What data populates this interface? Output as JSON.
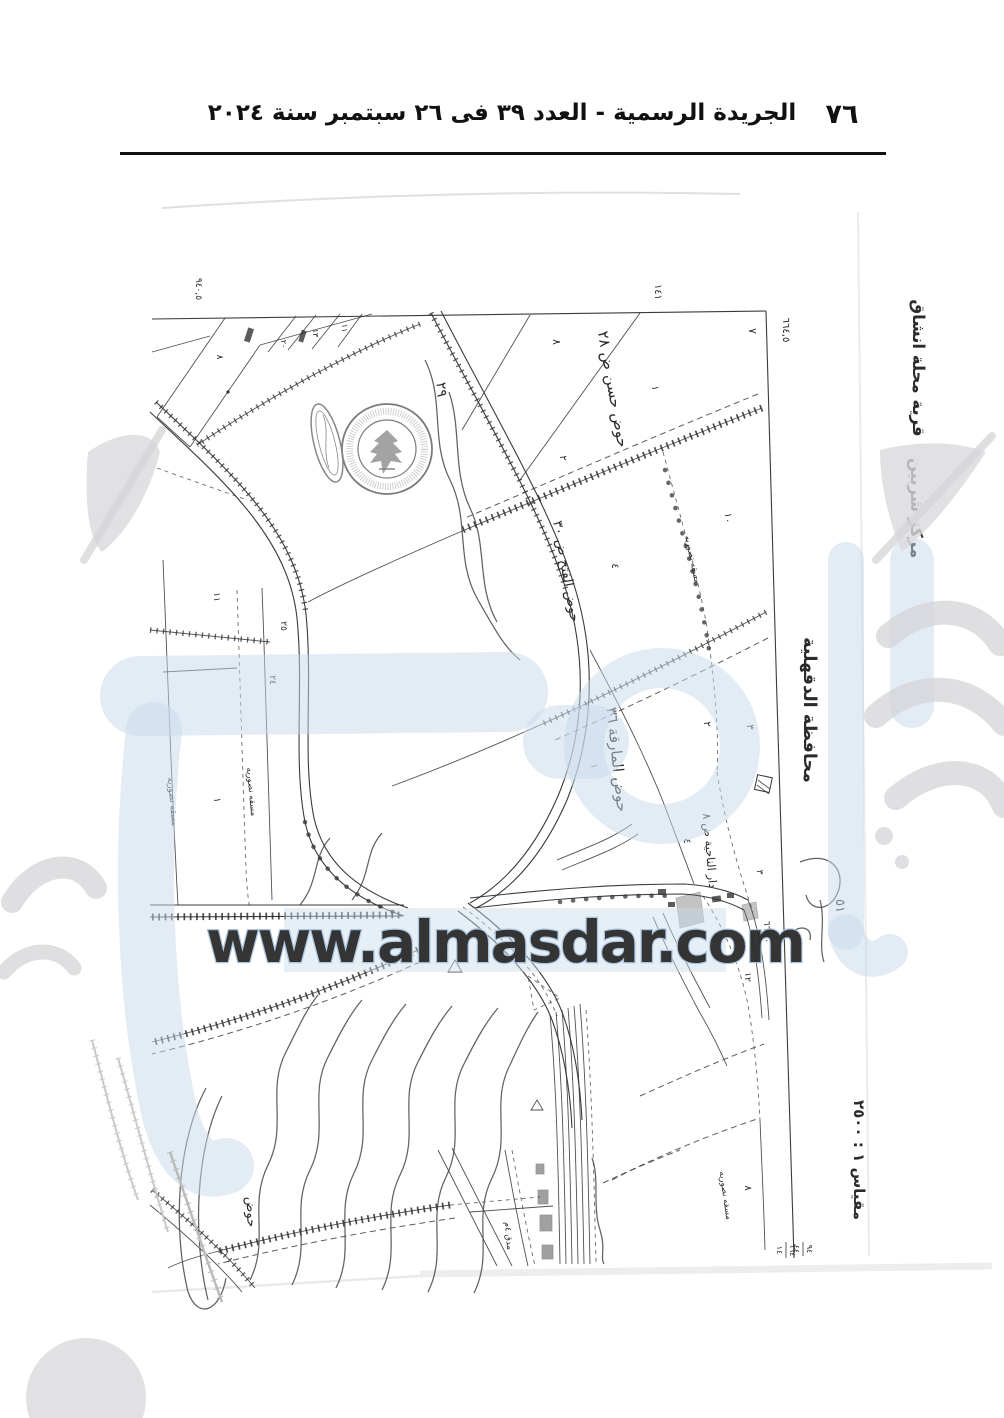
{
  "header": {
    "title": "الجريدة الرسمية - العدد ٣٩ فى ٢٦ سبتمبر سنة ٢٠٢٤",
    "page_number": "٧٦"
  },
  "watermark": {
    "url_text": "www.almasdar.com",
    "blue": "#c8daec",
    "gray": "#d7d7d9"
  },
  "map": {
    "margin_labels": {
      "village": "قرية محلة انشاق",
      "district": "مركز شربين",
      "governorate": "محافظة الدقهلية",
      "scale": "مقياس ١ : ٢٥٠٠"
    },
    "basin_labels": {
      "b28": "حوض حسن ض ٢٨",
      "b30": "حوض الفتح ض ٣٠",
      "b36": "حوض المارقة ٣٦",
      "boundary": "دار الناحية ض ٨"
    },
    "canal_label": "مسقه نصوريه",
    "path_label": "مدق ٤م",
    "handwriting": {
      "hawd": "حوض",
      "num29": "٢٩",
      "num51": "٥١"
    },
    "coordinates": {
      "top_left": "٩٤٠,٥",
      "top": "١٤١",
      "top_right": "٦٦٤,٥",
      "right": "٦٦٥,٠",
      "f1a": "٦٦٤",
      "f1b": "١٤",
      "f2a": "٩٤",
      "f2b": "٤٤"
    },
    "parcel_numbers": [
      "٧",
      "٨",
      "١",
      "٢",
      "١٠",
      "٤",
      "٢",
      "٣",
      "١",
      "٤",
      "١١",
      "٢٥",
      "٢٤",
      "١",
      "٨",
      "١٢",
      "٨",
      "١٣",
      "١١",
      "٢٠",
      "٣"
    ]
  }
}
